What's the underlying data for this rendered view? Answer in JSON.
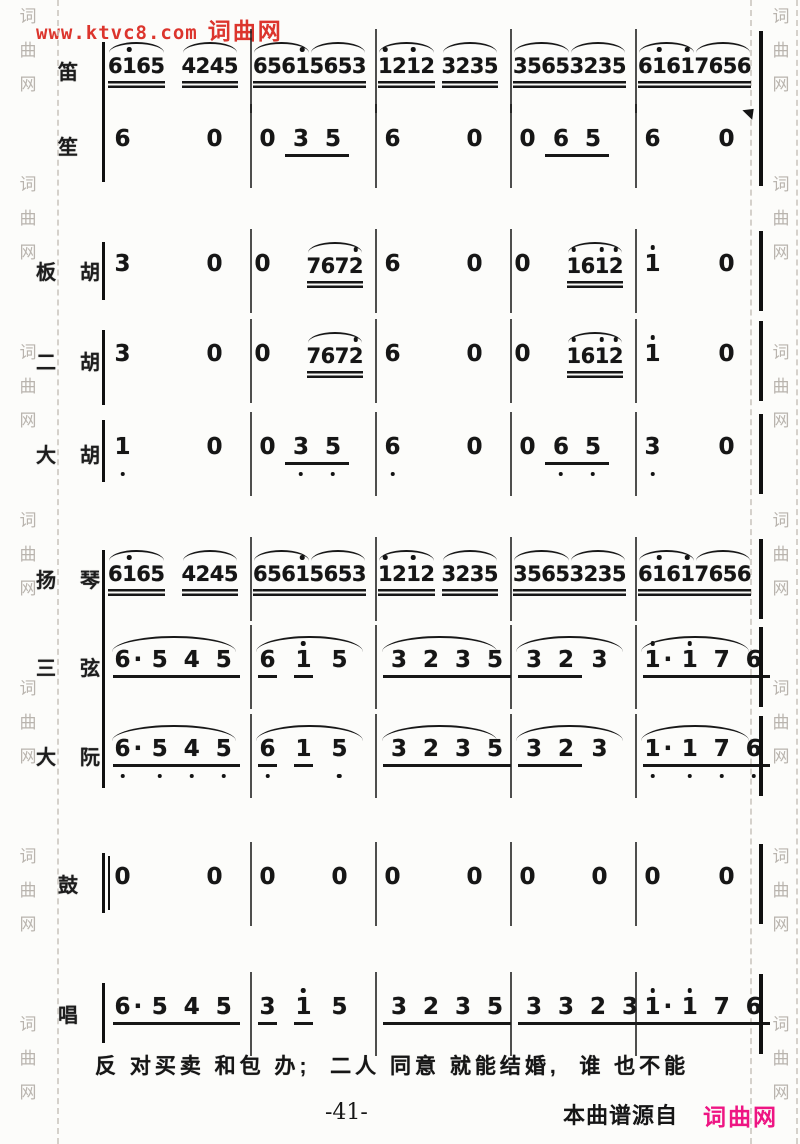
{
  "watermarks": {
    "top_url": "www.ktvc8.com",
    "top_site": "词曲网",
    "top_color": "#dc352d",
    "side_chars": [
      "词",
      "曲",
      "网"
    ],
    "side_color": "#b9b4ae"
  },
  "footer": {
    "page_number": "-41-",
    "source_label": "本曲谱源自",
    "source_site": "词曲网",
    "source_site_color": "#ee1583"
  },
  "lyrics": {
    "text": "反 对买卖 和包 办;  二人 同意 就能结婚,  谁 也不能"
  },
  "score": {
    "rows": [
      {
        "label": "笛",
        "cells": [
          {
            "g": [
              {
                "d": "6165",
                "u": 2,
                "s": 1,
                "h": [
                  1
                ]
              },
              {
                "d": "4245",
                "u": 2,
                "s": 1
              }
            ]
          },
          {
            "g": [
              {
                "d": "6561",
                "u": 2,
                "s": 1,
                "h": [
                  3
                ]
              },
              {
                "d": "5653",
                "u": 2,
                "s": 1
              }
            ]
          },
          {
            "g": [
              {
                "d": "1212",
                "u": 2,
                "s": 1,
                "h": [
                  0,
                  2
                ]
              },
              {
                "d": "3235",
                "u": 2,
                "s": 1
              }
            ]
          },
          {
            "g": [
              {
                "d": "3565",
                "u": 2,
                "s": 1
              },
              {
                "d": "3235",
                "u": 2,
                "s": 1
              }
            ]
          },
          {
            "g": [
              {
                "d": "6161",
                "u": 2,
                "s": 1,
                "h": [
                  1,
                  3
                ]
              },
              {
                "d": "7656",
                "u": 2,
                "s": 1
              }
            ]
          }
        ]
      },
      {
        "label": "笙",
        "cells": [
          {
            "g": [
              {
                "d": "6"
              },
              {
                "d": "0"
              }
            ]
          },
          {
            "g": [
              {
                "d": "0"
              },
              {
                "d": "35",
                "u": 1,
                "sp": 1
              }
            ]
          },
          {
            "g": [
              {
                "d": "6"
              },
              {
                "d": "0"
              }
            ]
          },
          {
            "g": [
              {
                "d": "0"
              },
              {
                "d": "65",
                "u": 1,
                "sp": 1
              }
            ]
          },
          {
            "g": [
              {
                "d": "6"
              },
              {
                "d": "0"
              }
            ]
          }
        ]
      },
      {
        "label": "板胡",
        "cells": [
          {
            "g": [
              {
                "d": "3"
              },
              {
                "d": "0"
              }
            ]
          },
          {
            "g": [
              {
                "d": "0"
              },
              {
                "d": "7672",
                "u": 2,
                "s": 1,
                "h": [
                  3
                ]
              }
            ]
          },
          {
            "g": [
              {
                "d": "6"
              },
              {
                "d": "0"
              }
            ]
          },
          {
            "g": [
              {
                "d": "0"
              },
              {
                "d": "1612",
                "u": 2,
                "s": 1,
                "h": [
                  0,
                  2,
                  3
                ]
              }
            ]
          },
          {
            "g": [
              {
                "d": "1",
                "h": [
                  0
                ]
              },
              {
                "d": "0"
              }
            ]
          }
        ]
      },
      {
        "label": "二胡",
        "cells": [
          {
            "g": [
              {
                "d": "3"
              },
              {
                "d": "0"
              }
            ]
          },
          {
            "g": [
              {
                "d": "0"
              },
              {
                "d": "7672",
                "u": 2,
                "s": 1,
                "h": [
                  3
                ]
              }
            ]
          },
          {
            "g": [
              {
                "d": "6"
              },
              {
                "d": "0"
              }
            ]
          },
          {
            "g": [
              {
                "d": "0"
              },
              {
                "d": "1612",
                "u": 2,
                "s": 1,
                "h": [
                  0,
                  2,
                  3
                ]
              }
            ]
          },
          {
            "g": [
              {
                "d": "1",
                "h": [
                  0
                ]
              },
              {
                "d": "0"
              }
            ]
          }
        ]
      },
      {
        "label": "大胡",
        "cells": [
          {
            "g": [
              {
                "d": "1",
                "l": [
                  0
                ]
              },
              {
                "d": "0"
              }
            ]
          },
          {
            "g": [
              {
                "d": "0"
              },
              {
                "d": "35",
                "u": 1,
                "sp": 1,
                "l": [
                  0,
                  1
                ]
              }
            ]
          },
          {
            "g": [
              {
                "d": "6",
                "l": [
                  0
                ]
              },
              {
                "d": "0"
              }
            ]
          },
          {
            "g": [
              {
                "d": "0"
              },
              {
                "d": "65",
                "u": 1,
                "sp": 1,
                "l": [
                  0,
                  1
                ]
              }
            ]
          },
          {
            "g": [
              {
                "d": "3",
                "l": [
                  0
                ]
              },
              {
                "d": "0"
              }
            ]
          }
        ]
      },
      {
        "label": "扬琴",
        "cells": [
          {
            "g": [
              {
                "d": "6165",
                "u": 2,
                "s": 1,
                "h": [
                  1
                ]
              },
              {
                "d": "4245",
                "u": 2,
                "s": 1
              }
            ]
          },
          {
            "g": [
              {
                "d": "6561",
                "u": 2,
                "s": 1,
                "h": [
                  3
                ]
              },
              {
                "d": "5653",
                "u": 2,
                "s": 1
              }
            ]
          },
          {
            "g": [
              {
                "d": "1212",
                "u": 2,
                "s": 1,
                "h": [
                  0,
                  2
                ]
              },
              {
                "d": "3235",
                "u": 2,
                "s": 1
              }
            ]
          },
          {
            "g": [
              {
                "d": "3565",
                "u": 2,
                "s": 1
              },
              {
                "d": "3235",
                "u": 2,
                "s": 1
              }
            ]
          },
          {
            "g": [
              {
                "d": "6161",
                "u": 2,
                "s": 1,
                "h": [
                  1,
                  3
                ]
              },
              {
                "d": "7656",
                "u": 2,
                "s": 1
              }
            ]
          }
        ]
      },
      {
        "label": "三弦",
        "cells": [
          {
            "slur": 1,
            "g": [
              {
                "d": "6·",
                "u": 1
              },
              {
                "d": "545",
                "u": 1,
                "sp": 1
              }
            ]
          },
          {
            "slur": 1,
            "g": [
              {
                "d": "6",
                "u": 1
              },
              {
                "d": "1",
                "u": 1,
                "h": [
                  0
                ]
              },
              {
                "d": "5"
              }
            ]
          },
          {
            "slur": 1,
            "g": [
              {
                "d": "32",
                "u": 1,
                "sp": 1
              },
              {
                "d": "35",
                "u": 1,
                "sp": 1
              }
            ]
          },
          {
            "slur": 1,
            "g": [
              {
                "d": "32",
                "u": 1,
                "sp": 1
              },
              {
                "d": "3"
              }
            ]
          },
          {
            "slur": 1,
            "g": [
              {
                "d": "1·",
                "u": 1,
                "h": [
                  0
                ]
              },
              {
                "d": "176",
                "u": 1,
                "sp": 1,
                "h": [
                  0
                ]
              }
            ]
          }
        ]
      },
      {
        "label": "大阮",
        "cells": [
          {
            "slur": 1,
            "g": [
              {
                "d": "6·",
                "u": 1,
                "l": [
                  0
                ]
              },
              {
                "d": "545",
                "u": 1,
                "sp": 1,
                "l": [
                  0,
                  1,
                  2
                ]
              }
            ]
          },
          {
            "slur": 1,
            "g": [
              {
                "d": "6",
                "u": 1,
                "l": [
                  0
                ]
              },
              {
                "d": "1",
                "u": 1
              },
              {
                "d": "5",
                "l": [
                  0
                ]
              }
            ]
          },
          {
            "slur": 1,
            "g": [
              {
                "d": "32",
                "u": 1,
                "sp": 1
              },
              {
                "d": "35",
                "u": 1,
                "sp": 1
              }
            ]
          },
          {
            "slur": 1,
            "g": [
              {
                "d": "32",
                "u": 1,
                "sp": 1
              },
              {
                "d": "3"
              }
            ]
          },
          {
            "slur": 1,
            "g": [
              {
                "d": "1·",
                "u": 1,
                "l": [
                  0
                ]
              },
              {
                "d": "176",
                "u": 1,
                "sp": 1,
                "l": [
                  0,
                  1,
                  2
                ]
              }
            ]
          }
        ]
      },
      {
        "label": "鼓",
        "cells": [
          {
            "g": [
              {
                "d": "0"
              },
              {
                "d": "0"
              }
            ]
          },
          {
            "g": [
              {
                "d": "0"
              },
              {
                "d": "0"
              }
            ]
          },
          {
            "g": [
              {
                "d": "0"
              },
              {
                "d": "0"
              }
            ]
          },
          {
            "g": [
              {
                "d": "0"
              },
              {
                "d": "0"
              }
            ]
          },
          {
            "g": [
              {
                "d": "0"
              },
              {
                "d": "0"
              }
            ]
          }
        ]
      },
      {
        "label": "唱",
        "cells": [
          {
            "g": [
              {
                "d": "6·",
                "u": 1
              },
              {
                "d": "545",
                "u": 1,
                "sp": 1
              }
            ]
          },
          {
            "g": [
              {
                "d": "3",
                "u": 1
              },
              {
                "d": "1",
                "u": 1,
                "h": [
                  0
                ]
              },
              {
                "d": "5"
              }
            ]
          },
          {
            "g": [
              {
                "d": "32",
                "u": 1,
                "sp": 1
              },
              {
                "d": "35",
                "u": 1,
                "sp": 1
              }
            ]
          },
          {
            "g": [
              {
                "d": "3323",
                "u": 1,
                "sp": 1
              }
            ]
          },
          {
            "g": [
              {
                "d": "1·",
                "u": 1,
                "h": [
                  0
                ]
              },
              {
                "d": "176",
                "u": 1,
                "sp": 1,
                "h": [
                  0
                ]
              }
            ]
          }
        ]
      }
    ]
  }
}
